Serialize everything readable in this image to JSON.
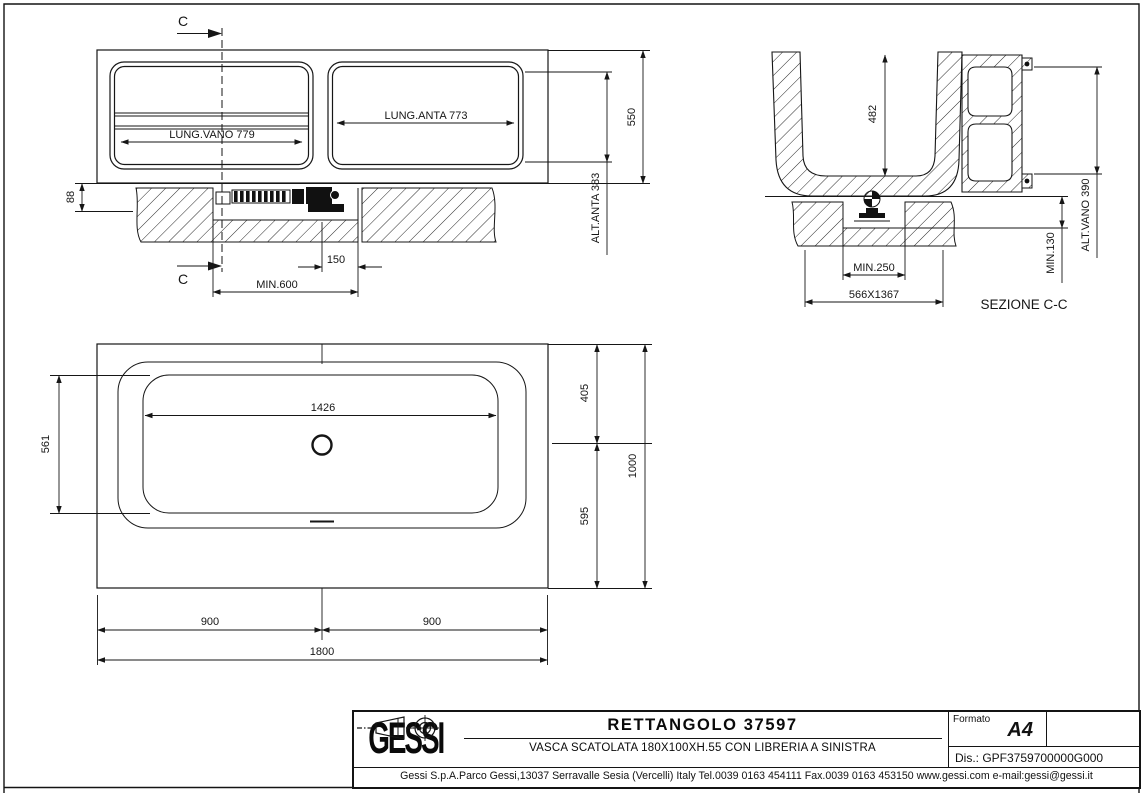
{
  "drawing": {
    "section_marker": "C",
    "front_view": {
      "lung_vano": "LUNG.VANO 779",
      "lung_anta": "LUNG.ANTA 773",
      "height_total": "550",
      "alt_anta": "ALT.ANTA 383",
      "dim_88": "88",
      "dim_150": "150",
      "min_600": "MIN.600"
    },
    "section_view": {
      "label": "SEZIONE C-C",
      "depth_482": "482",
      "alt_vano": "ALT.VANO 390",
      "min_130": "MIN.130",
      "min_250": "MIN.250",
      "base": "566X1367"
    },
    "plan_view": {
      "dim_1426": "1426",
      "dim_561": "561",
      "dim_405": "405",
      "dim_595": "595",
      "dim_1000": "1000",
      "dim_900_left": "900",
      "dim_900_right": "900",
      "dim_1800": "1800"
    }
  },
  "title_block": {
    "logo": "GESSI",
    "title": "RETTANGOLO 37597",
    "subtitle": "VASCA SCATOLATA 180X100XH.55 CON LIBRERIA A SINISTRA",
    "formato_label": "Formato",
    "formato_value": "A4",
    "drawing_number": "Dis.: GPF3759700000G000",
    "address": "Gessi S.p.A.Parco Gessi,13037 Serravalle Sesia (Vercelli) Italy Tel.0039 0163 454111 Fax.0039 0163 453150 www.gessi.com e-mail:gessi@gessi.it"
  },
  "colors": {
    "line": "#161616",
    "background": "#ffffff"
  }
}
